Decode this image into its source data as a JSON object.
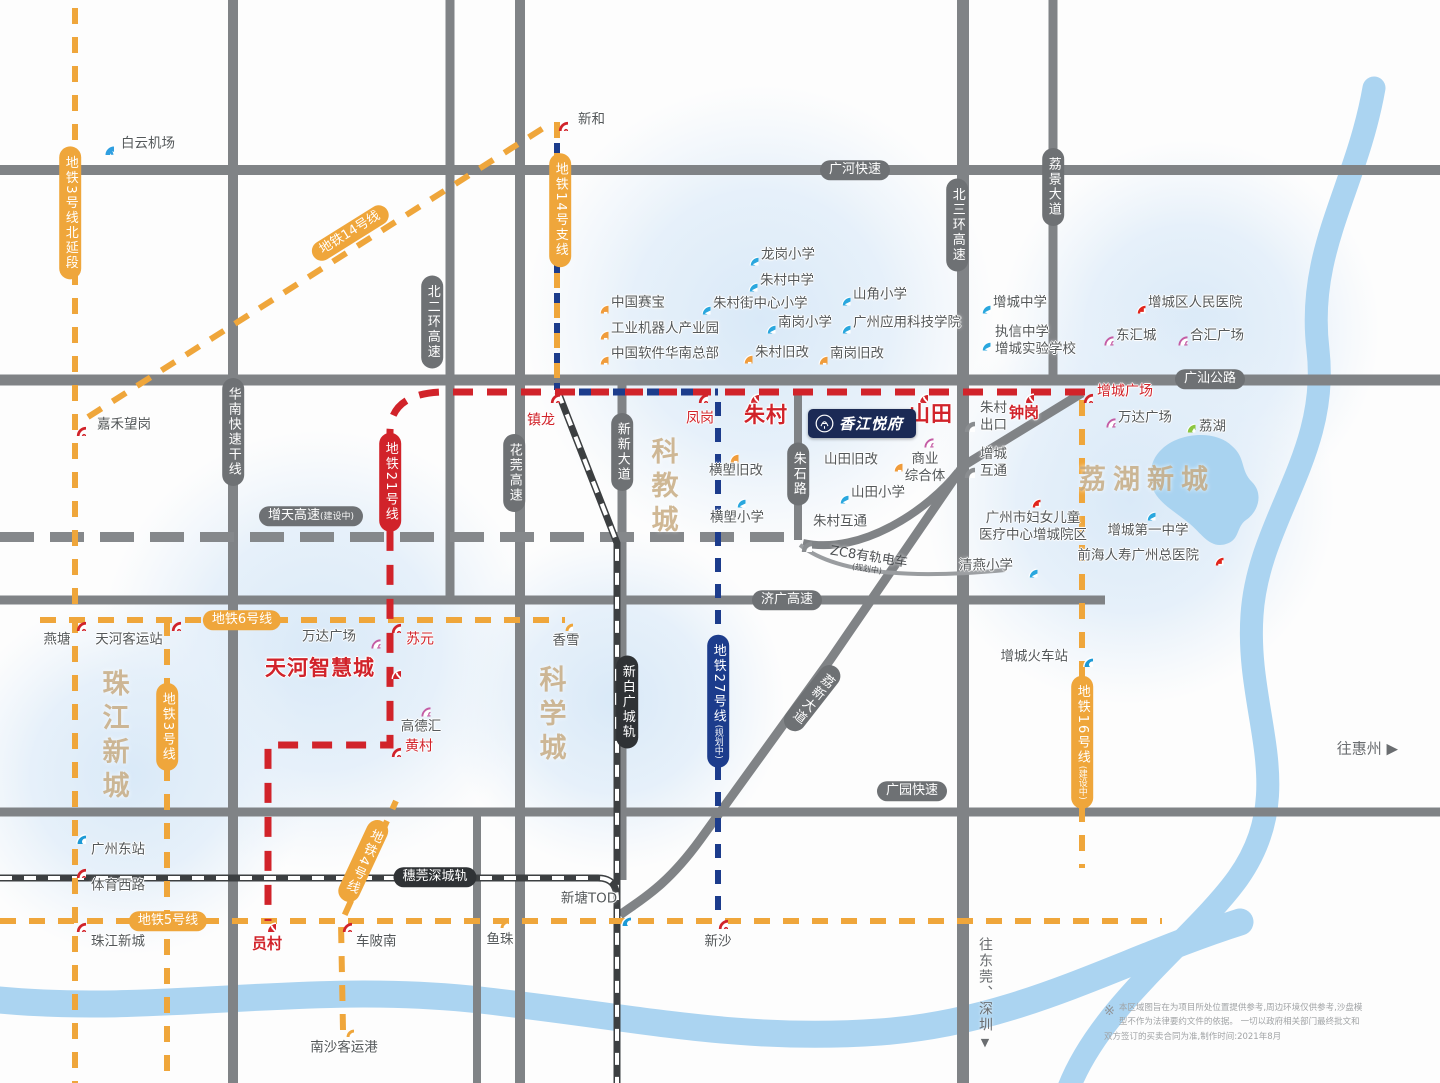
{
  "meta": {
    "type": "real-estate location map",
    "colors": {
      "metro_orange": "#EFA63B",
      "metro_red": "#D1232A",
      "metro_navy": "#1C3C8C",
      "road_gray": "#808386",
      "water_blue": "#ABD4F1",
      "landmark_tan": "#C9AD84",
      "school_blue": "#2AA7DE",
      "hospital_red": "#E1251B",
      "mall_pink": "#C45CA4",
      "industry_orange": "#F09C3B",
      "park_green": "#8CC63F",
      "project_navy": "#1B2A55"
    }
  },
  "map": {
    "project": {
      "name": "香江悦府"
    },
    "landmarks": [
      {
        "text": "珠江新城",
        "x": 113,
        "y": 737,
        "mode": "v"
      },
      {
        "text": "科学城",
        "x": 550,
        "y": 716,
        "mode": "v"
      },
      {
        "text": "科教城",
        "x": 662,
        "y": 488,
        "mode": "v"
      },
      {
        "text": "荔湖新城",
        "x": 1147,
        "y": 477,
        "mode": "h"
      }
    ],
    "metro_line_labels": [
      {
        "text": "地铁3号线北延段",
        "sub": "",
        "x": 70,
        "y": 213,
        "color": "orange",
        "mode": "v",
        "rot": 0
      },
      {
        "text": "地铁14号线",
        "sub": "",
        "x": 350,
        "y": 233,
        "color": "orange",
        "mode": "h",
        "rot": -32
      },
      {
        "text": "地铁14号支线",
        "sub": "",
        "x": 560,
        "y": 210,
        "color": "orange",
        "mode": "v",
        "rot": 0
      },
      {
        "text": "地铁6号线",
        "sub": "",
        "x": 242,
        "y": 620,
        "color": "orange",
        "mode": "h",
        "rot": 0
      },
      {
        "text": "地铁3号线",
        "sub": "",
        "x": 167,
        "y": 727,
        "color": "orange",
        "mode": "v",
        "rot": 0
      },
      {
        "text": "地铁21号线",
        "sub": "",
        "x": 390,
        "y": 482,
        "color": "red",
        "mode": "v",
        "rot": 0
      },
      {
        "text": "地铁27号线",
        "sub": "(规划中)",
        "x": 718,
        "y": 701,
        "color": "navy",
        "mode": "v",
        "rot": 0
      },
      {
        "text": "地铁4号线",
        "sub": "",
        "x": 363,
        "y": 861,
        "color": "orange",
        "mode": "v",
        "rot": 25
      },
      {
        "text": "地铁5号线",
        "sub": "",
        "x": 168,
        "y": 921,
        "color": "orange",
        "mode": "h",
        "rot": 0
      },
      {
        "text": "地铁16号线",
        "sub": "(建设中)",
        "x": 1082,
        "y": 742,
        "color": "orange",
        "mode": "v",
        "rot": 0
      }
    ],
    "road_labels": [
      {
        "text": "广河快速",
        "sub": "",
        "x": 855,
        "y": 170,
        "color": "gray",
        "mode": "h",
        "rot": 0
      },
      {
        "text": "广汕公路",
        "sub": "",
        "x": 1210,
        "y": 379,
        "color": "gray",
        "mode": "h",
        "rot": 0
      },
      {
        "text": "济广高速",
        "sub": "",
        "x": 787,
        "y": 600,
        "color": "gray",
        "mode": "h",
        "rot": 0
      },
      {
        "text": "广园快速",
        "sub": "",
        "x": 912,
        "y": 791,
        "color": "gray",
        "mode": "h",
        "rot": 0
      },
      {
        "text": "增天高速",
        "sub": "(建设中)",
        "x": 311,
        "y": 516,
        "color": "gray",
        "mode": "h",
        "rot": 0
      },
      {
        "text": "北二环高速",
        "sub": "",
        "x": 432,
        "y": 322,
        "color": "gray",
        "mode": "v",
        "rot": 0
      },
      {
        "text": "北三环高速",
        "sub": "",
        "x": 957,
        "y": 225,
        "color": "gray",
        "mode": "v",
        "rot": 0
      },
      {
        "text": "荔景大道",
        "sub": "",
        "x": 1053,
        "y": 187,
        "color": "gray",
        "mode": "v",
        "rot": 0
      },
      {
        "text": "华南快速干线",
        "sub": "",
        "x": 233,
        "y": 432,
        "color": "gray",
        "mode": "v",
        "rot": 0
      },
      {
        "text": "花莞高速",
        "sub": "",
        "x": 514,
        "y": 473,
        "color": "gray",
        "mode": "v",
        "rot": 0
      },
      {
        "text": "新新大道",
        "sub": "",
        "x": 622,
        "y": 452,
        "color": "gray",
        "mode": "v",
        "rot": 0
      },
      {
        "text": "朱石路",
        "sub": "",
        "x": 798,
        "y": 474,
        "color": "gray",
        "mode": "v",
        "rot": 0
      },
      {
        "text": "荔新大道",
        "sub": "",
        "x": 812,
        "y": 698,
        "color": "gray",
        "mode": "v",
        "rot": 38
      },
      {
        "text": "穗莞深城轨",
        "sub": "",
        "x": 435,
        "y": 877,
        "color": "black",
        "mode": "h",
        "rot": 0
      },
      {
        "text": "新白广城轨",
        "sub": "",
        "x": 627,
        "y": 702,
        "color": "black",
        "mode": "v",
        "rot": 0
      }
    ],
    "stations": [
      {
        "name": "新和",
        "x": 557,
        "y": 120,
        "icon": "metro",
        "lx": 578,
        "ly": 120,
        "la": "L",
        "ls": "g"
      },
      {
        "name": "嘉禾望岗",
        "x": 75,
        "y": 425,
        "icon": "metro",
        "lx": 97,
        "ly": 425,
        "la": "L",
        "ls": "g"
      },
      {
        "name": "燕塘",
        "x": 75,
        "y": 620,
        "icon": "metro",
        "lx": 57,
        "ly": 640,
        "la": "C",
        "ls": "g"
      },
      {
        "name": "天河客运站",
        "x": 170,
        "y": 620,
        "icon": "metro",
        "lx": 129,
        "ly": 640,
        "la": "C",
        "ls": "g"
      },
      {
        "name": "苏元",
        "x": 390,
        "y": 622,
        "icon": "metro",
        "lx": 406,
        "ly": 640,
        "la": "L",
        "ls": "r"
      },
      {
        "name": "香雪",
        "x": 562,
        "y": 620,
        "icon": "open",
        "lx": 566,
        "ly": 641,
        "la": "C",
        "ls": "g"
      },
      {
        "name": "镇龙",
        "x": 549,
        "y": 392,
        "icon": "metro",
        "lx": 541,
        "ly": 421,
        "la": "C",
        "ls": "r"
      },
      {
        "name": "凤岗",
        "x": 697,
        "y": 392,
        "icon": "metro",
        "lx": 700,
        "ly": 419,
        "la": "C",
        "ls": "r"
      },
      {
        "name": "朱村",
        "x": 748,
        "y": 392,
        "icon": "xfer",
        "lx": 766,
        "ly": 415,
        "la": "C",
        "ls": "R"
      },
      {
        "name": "山田",
        "x": 917,
        "y": 392,
        "icon": "xfer",
        "lx": 931,
        "ly": 414,
        "la": "C",
        "ls": "R"
      },
      {
        "name": "钟岗",
        "x": 1023,
        "y": 392,
        "icon": "xfer",
        "lx": 1024,
        "ly": 413,
        "la": "C",
        "ls": "r2"
      },
      {
        "name": "增城广场",
        "x": 1082,
        "y": 392,
        "icon": "metro",
        "lx": 1097,
        "ly": 392,
        "la": "L",
        "ls": "r"
      },
      {
        "name": "天河智慧城",
        "x": 390,
        "y": 668,
        "icon": "xfer",
        "lx": 375,
        "ly": 668,
        "la": "R",
        "ls": "R"
      },
      {
        "name": "黄村",
        "x": 390,
        "y": 746,
        "icon": "metro",
        "lx": 405,
        "ly": 747,
        "la": "L",
        "ls": "r"
      },
      {
        "name": "广州东站",
        "x": 75,
        "y": 833,
        "icon": "rail",
        "lx": 91,
        "ly": 850,
        "la": "L",
        "ls": "g"
      },
      {
        "name": "体育西路",
        "x": 75,
        "y": 867,
        "icon": "metro",
        "lx": 91,
        "ly": 886,
        "la": "L",
        "ls": "g"
      },
      {
        "name": "珠江新城",
        "x": 75,
        "y": 921,
        "icon": "metro",
        "lx": 91,
        "ly": 942,
        "la": "L",
        "ls": "g"
      },
      {
        "name": "员村",
        "x": 265,
        "y": 921,
        "icon": "xfer",
        "lx": 267,
        "ly": 944,
        "la": "C",
        "ls": "r2"
      },
      {
        "name": "车陂南",
        "x": 341,
        "y": 921,
        "icon": "metro",
        "lx": 356,
        "ly": 942,
        "la": "L",
        "ls": "g"
      },
      {
        "name": "鱼珠",
        "x": 497,
        "y": 917,
        "icon": "open",
        "lx": 500,
        "ly": 940,
        "la": "C",
        "ls": "g"
      },
      {
        "name": "新塘TOD",
        "x": 620,
        "y": 915,
        "icon": "rail",
        "lx": 589,
        "ly": 899,
        "la": "C",
        "ls": "g"
      },
      {
        "name": "新沙",
        "x": 717,
        "y": 918,
        "icon": "metro",
        "lx": 718,
        "ly": 942,
        "la": "C",
        "ls": "g"
      },
      {
        "name": "南沙客运港",
        "x": 343,
        "y": 1026,
        "icon": "open",
        "lx": 344,
        "ly": 1048,
        "la": "C",
        "ls": "g"
      },
      {
        "name": "增城火车站",
        "x": 1082,
        "y": 656,
        "icon": "rail",
        "lx": 1068,
        "ly": 657,
        "la": "R",
        "ls": "g"
      },
      {
        "name": "白云机场",
        "x": 103,
        "y": 144,
        "icon": "plane",
        "lx": 121,
        "ly": 144,
        "la": "L",
        "ls": "g"
      }
    ],
    "junctions": [
      {
        "name": "朱村\n出口",
        "x": 963,
        "y": 420,
        "lx": 980,
        "ly": 417,
        "la": "L"
      },
      {
        "name": "增城\n互通",
        "x": 963,
        "y": 466,
        "lx": 980,
        "ly": 463,
        "la": "L"
      },
      {
        "name": "朱村互通",
        "x": 800,
        "y": 540,
        "lx": 813,
        "ly": 522,
        "la": "L"
      }
    ],
    "pois": [
      {
        "name": "龙岗小学",
        "x": 748,
        "y": 255,
        "type": "school",
        "lx": 761,
        "ly": 255,
        "la": "L"
      },
      {
        "name": "朱村中学",
        "x": 747,
        "y": 281,
        "type": "school",
        "lx": 760,
        "ly": 281,
        "la": "L"
      },
      {
        "name": "山角小学",
        "x": 840,
        "y": 295,
        "type": "school",
        "lx": 853,
        "ly": 295,
        "la": "L"
      },
      {
        "name": "朱村街中心小学",
        "x": 700,
        "y": 304,
        "type": "school",
        "lx": 713,
        "ly": 304,
        "la": "L"
      },
      {
        "name": "南岗小学",
        "x": 765,
        "y": 323,
        "type": "school",
        "lx": 778,
        "ly": 323,
        "la": "L"
      },
      {
        "name": "广州应用科技学院",
        "x": 840,
        "y": 323,
        "type": "school",
        "lx": 853,
        "ly": 323,
        "la": "L"
      },
      {
        "name": "增城中学",
        "x": 980,
        "y": 303,
        "type": "school",
        "lx": 993,
        "ly": 303,
        "la": "L"
      },
      {
        "name": "执信中学\n增城实验学校",
        "x": 980,
        "y": 340,
        "type": "school",
        "lx": 995,
        "ly": 341,
        "la": "L"
      },
      {
        "name": "横塱小学",
        "x": 735,
        "y": 497,
        "type": "school",
        "lx": 737,
        "ly": 518,
        "la": "C"
      },
      {
        "name": "山田小学",
        "x": 838,
        "y": 493,
        "type": "school",
        "lx": 851,
        "ly": 493,
        "la": "L"
      },
      {
        "name": "增城第一中学",
        "x": 1145,
        "y": 510,
        "type": "school",
        "lx": 1148,
        "ly": 531,
        "la": "C"
      },
      {
        "name": "清燕小学",
        "x": 1027,
        "y": 567,
        "type": "school",
        "lx": 1013,
        "ly": 566,
        "la": "R"
      },
      {
        "name": "中国赛宝",
        "x": 598,
        "y": 303,
        "type": "industry",
        "lx": 611,
        "ly": 303,
        "la": "L"
      },
      {
        "name": "工业机器人产业园",
        "x": 598,
        "y": 329,
        "type": "industry",
        "lx": 611,
        "ly": 329,
        "la": "L"
      },
      {
        "name": "中国软件华南总部",
        "x": 598,
        "y": 354,
        "type": "industry",
        "lx": 611,
        "ly": 354,
        "la": "L"
      },
      {
        "name": "朱村旧改",
        "x": 742,
        "y": 353,
        "type": "industry",
        "lx": 755,
        "ly": 353,
        "la": "L"
      },
      {
        "name": "南岗旧改",
        "x": 817,
        "y": 354,
        "type": "industry",
        "lx": 830,
        "ly": 354,
        "la": "L"
      },
      {
        "name": "横塱旧改",
        "x": 728,
        "y": 452,
        "type": "industry",
        "lx": 736,
        "ly": 471,
        "la": "C"
      },
      {
        "name": "山田旧改",
        "x": 892,
        "y": 461,
        "type": "industry",
        "lx": 878,
        "ly": 460,
        "la": "R"
      },
      {
        "name": "东汇城",
        "x": 1103,
        "y": 335,
        "type": "mall",
        "lx": 1116,
        "ly": 336,
        "la": "L"
      },
      {
        "name": "合汇广场",
        "x": 1177,
        "y": 335,
        "type": "mall",
        "lx": 1190,
        "ly": 336,
        "la": "L"
      },
      {
        "name": "万达广场",
        "x": 1105,
        "y": 417,
        "type": "mall",
        "lx": 1118,
        "ly": 418,
        "la": "L"
      },
      {
        "name": "万达广场",
        "x": 370,
        "y": 638,
        "type": "mall",
        "lx": 356,
        "ly": 637,
        "la": "R"
      },
      {
        "name": "高德汇",
        "x": 420,
        "y": 706,
        "type": "mall",
        "lx": 421,
        "ly": 727,
        "la": "C"
      },
      {
        "name": "商业\n综合体",
        "x": 923,
        "y": 437,
        "type": "mall",
        "lx": 925,
        "ly": 468,
        "la": "C"
      },
      {
        "name": "增城区人民医院",
        "x": 1135,
        "y": 303,
        "type": "hospital",
        "lx": 1148,
        "ly": 303,
        "la": "L"
      },
      {
        "name": "广州市妇女儿童\n医疗中心增城院区",
        "x": 1030,
        "y": 497,
        "type": "hospital",
        "lx": 1033,
        "ly": 527,
        "la": "C"
      },
      {
        "name": "前海人寿广州总医院",
        "x": 1213,
        "y": 555,
        "type": "hospital",
        "lx": 1199,
        "ly": 556,
        "la": "R"
      },
      {
        "name": "荔湖",
        "x": 1185,
        "y": 422,
        "type": "park",
        "lx": 1199,
        "ly": 427,
        "la": "L"
      }
    ],
    "tram": {
      "text": "ZC8有轨电车",
      "sub": "(规划中)"
    },
    "directions": {
      "huizhou": "往惠州 ▶",
      "dongguan": "往东莞、深圳",
      "dongguan_arrow": "▼"
    },
    "compass": {
      "n": "N",
      "w": "W",
      "e": "E",
      "s": "S"
    },
    "disclaimer": {
      "mark": "※",
      "line1": "本区域图旨在为项目所处位置提供参考,周边环境仅供参考,沙盘模型不作为法律要约文件的依据。",
      "line2": "一切以政府相关部门最终批文和双方签订的买卖合同为准,制作时间:2021年8月"
    }
  }
}
